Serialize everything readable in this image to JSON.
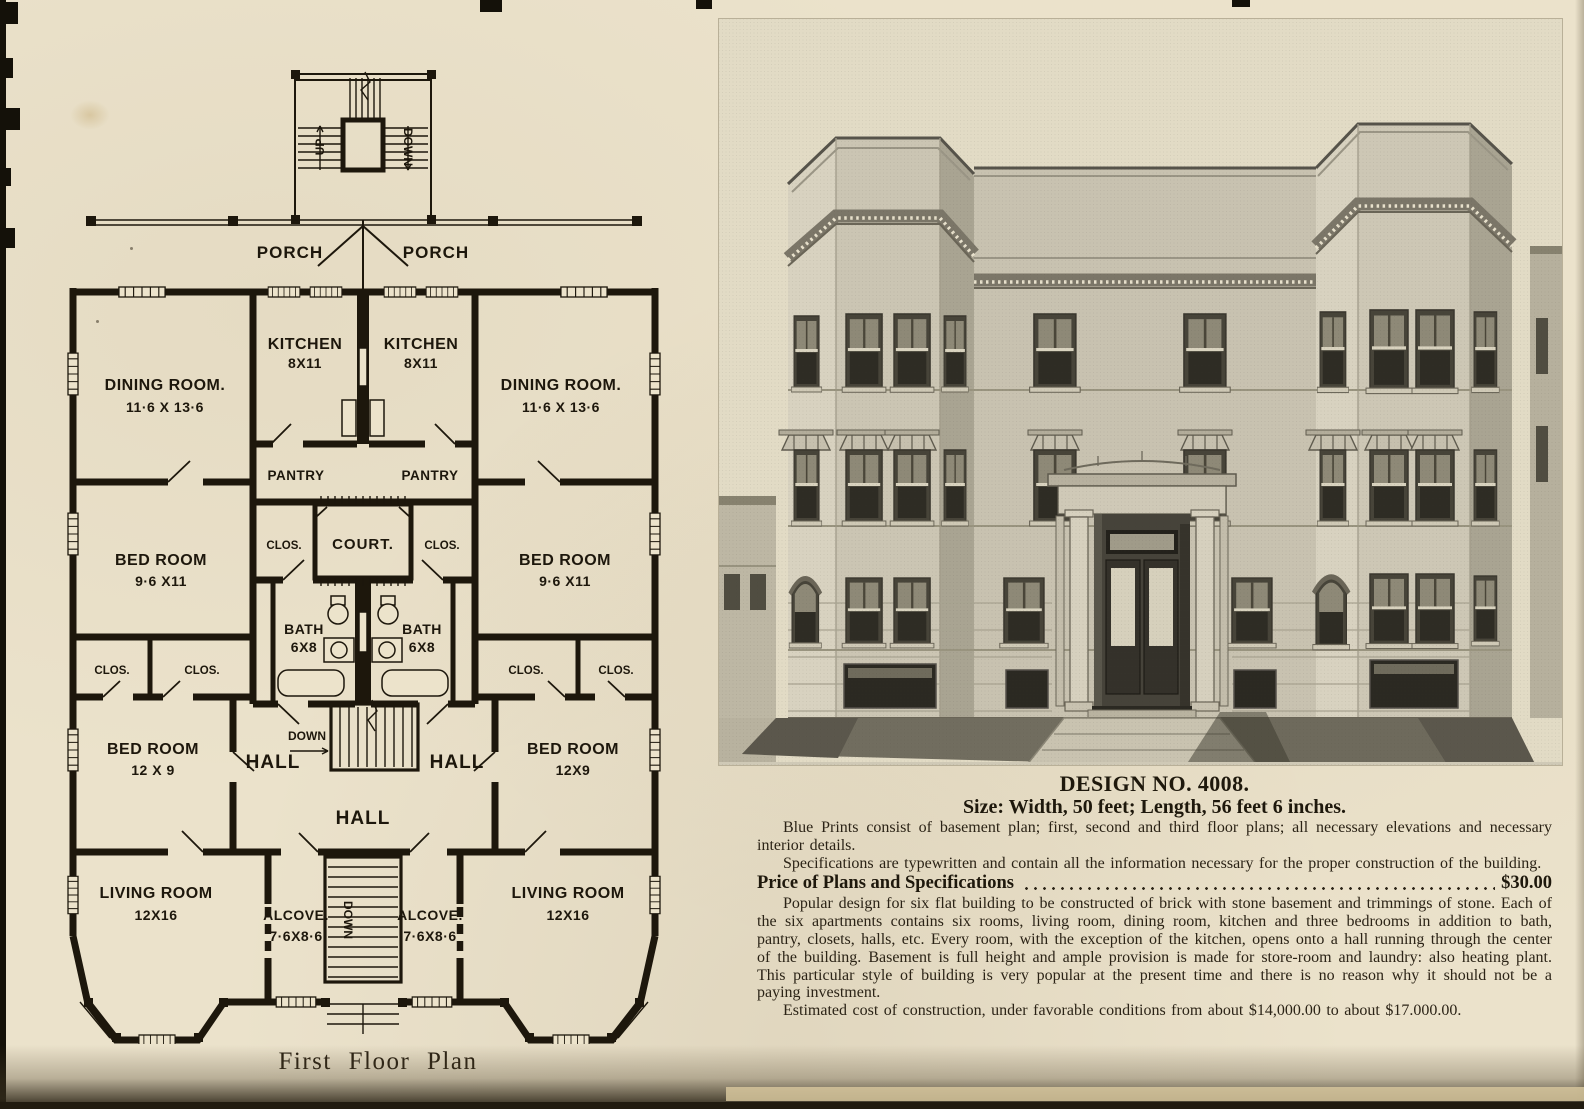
{
  "colors": {
    "paper": "#ebe2cb",
    "ink": "#2b2316",
    "plan_ink": "#1d170c"
  },
  "plan": {
    "caption": "First Floor Plan",
    "stairs": {
      "up": "UP",
      "down_rear": "DOWN",
      "down_mid": "DOWN",
      "down_front": "DOWN"
    },
    "porch_left": "PORCH",
    "porch_right": "PORCH",
    "rooms": {
      "kitchen_l_name": "KITCHEN",
      "kitchen_l_dims": "8X11",
      "kitchen_r_name": "KITCHEN",
      "kitchen_r_dims": "8X11",
      "dining_l_name": "DINING ROOM.",
      "dining_l_dims": "11·6 X 13·6",
      "dining_r_name": "DINING ROOM.",
      "dining_r_dims": "11·6 X 13·6",
      "pantry_l": "PANTRY",
      "pantry_r": "PANTRY",
      "court": "COURT.",
      "clos_court_l": "CLOS.",
      "clos_court_r": "CLOS.",
      "bed1_l_name": "BED ROOM",
      "bed1_l_dims": "9·6 X11",
      "bed1_r_name": "BED ROOM",
      "bed1_r_dims": "9·6 X11",
      "bath_l_name": "BATH",
      "bath_l_dims": "6X8",
      "bath_r_name": "BATH",
      "bath_r_dims": "6X8",
      "clos_l1": "CLOS.",
      "clos_l2": "CLOS.",
      "clos_r1": "CLOS.",
      "clos_r2": "CLOS.",
      "bed2_l_name": "BED ROOM",
      "bed2_l_dims": "12 X 9",
      "bed2_r_name": "BED ROOM",
      "bed2_r_dims": "12X9",
      "hall_l": "HALL",
      "hall_r": "HALL",
      "hall_c": "HALL",
      "living_l_name": "LIVING ROOM",
      "living_l_dims": "12X16",
      "living_r_name": "LIVING ROOM",
      "living_r_dims": "12X16",
      "alcove_l_name": "ALCOVE.",
      "alcove_l_dims": "7·6X8·6",
      "alcove_r_name": "ALCOVE.",
      "alcove_r_dims": "7·6X8·6"
    }
  },
  "details": {
    "title": "DESIGN NO. 4008.",
    "size": "Size: Width, 50 feet; Length, 56 feet 6 inches.",
    "p1": "Blue Prints consist of basement plan; first, second and third floor plans; all necessary elevations and necessary interior details.",
    "p2": "Specifications are typewritten and contain all the information necessary for the proper construction of the building.",
    "price_label": "Price of Plans and Specifications",
    "price_value": "$30.00",
    "p3": "Popular design for six flat building to be constructed of brick with stone basement and trimmings of stone.  Each of the six apartments contains six rooms, living room, dining room, kitchen and three bedrooms in addition to bath, pantry, closets, halls, etc.  Every room, with the exception of the kitchen, opens onto a hall running through the center of the building.  Basement is full height and ample provision is made for store-room and laundry: also heating plant.  This particular style of building is very popular at the present time and there is no reason why it should not be a paying investment.",
    "p4": "Estimated cost of construction, under favorable conditions from about $14,000.00 to about $17.000.00."
  }
}
